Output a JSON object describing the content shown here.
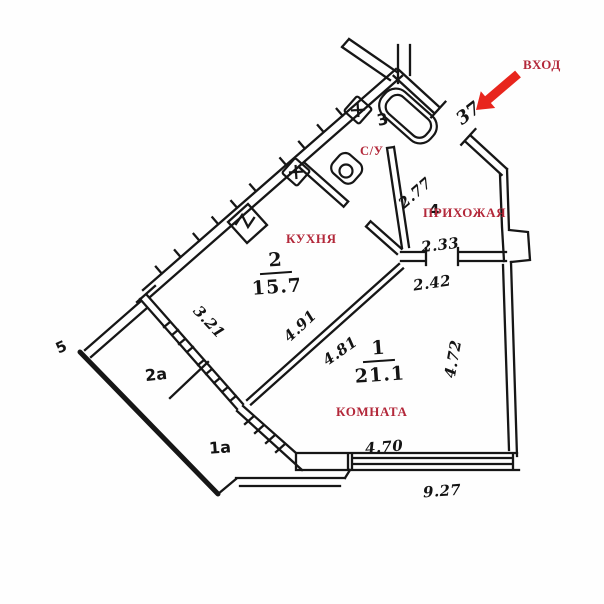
{
  "plan_title": "apartment floor plan",
  "labels": {
    "entrance": "ВХОД",
    "apartment_number": "37",
    "bathroom_number": "3",
    "bathroom_name": "С/У",
    "kitchen_name": "КУХНЯ",
    "kitchen_number": "2",
    "kitchen_area": "15.7",
    "room_name": "КОМНАТА",
    "room_number": "1",
    "room_area": "21.1",
    "hallway_number": "4",
    "hallway_name": "ПРИХОЖАЯ",
    "balcony_left": "2а",
    "balcony_bottom": "1а",
    "edge_mark": "5"
  },
  "dimensions": {
    "hallway_nw_wall": "2.77",
    "hallway_sw_wall": "2.33",
    "room_top_wall": "2.42",
    "room_right_wall": "4.72",
    "kitchen_diagonal": "4.91",
    "room_diagonal": "4.81",
    "kitchen_sw_wall": "3.21",
    "room_bottom_wall": "4.70",
    "bottom_total": "9.27"
  },
  "colors": {
    "walls": "#161616",
    "room_labels": "#b3283a",
    "entrance_arrow": "#e8251d",
    "background": "#fefefe"
  }
}
